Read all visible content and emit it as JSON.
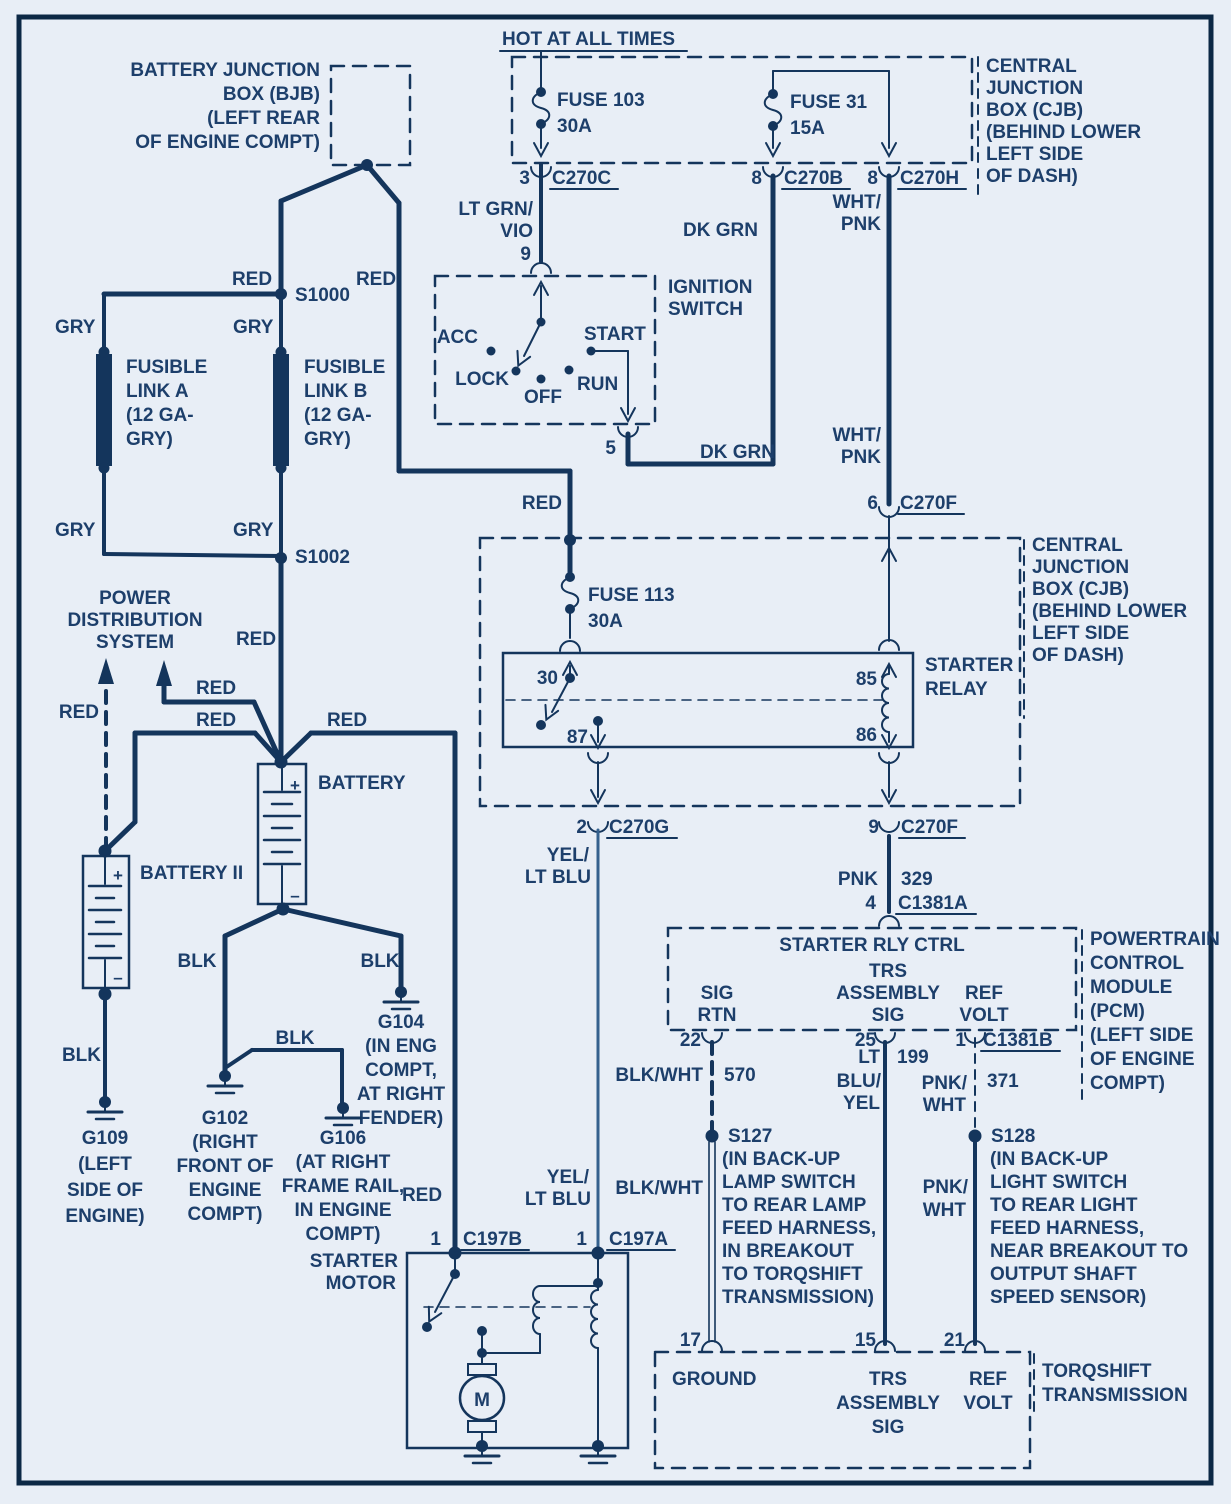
{
  "colors": {
    "background": "#e8eef6",
    "line": "#14355c",
    "text": "#1d3f6b",
    "wire_light": "#35618e"
  },
  "header": {
    "hot_at_all_times": "HOT AT ALL TIMES"
  },
  "bjb": {
    "label": [
      "BATTERY JUNCTION",
      "BOX (BJB)",
      "(LEFT REAR",
      "OF ENGINE COMPT)"
    ]
  },
  "cjb_top": {
    "label": [
      "CENTRAL",
      "JUNCTION",
      "BOX (CJB)",
      "(BEHIND LOWER",
      "LEFT SIDE",
      "OF DASH)"
    ],
    "fuse103": {
      "name": "FUSE 103",
      "rating": "30A"
    },
    "fuse31": {
      "name": "FUSE 31",
      "rating": "15A"
    }
  },
  "cjb_mid": {
    "label": [
      "CENTRAL",
      "JUNCTION",
      "BOX (CJB)",
      "(BEHIND LOWER",
      "LEFT SIDE",
      "OF DASH)"
    ],
    "fuse113": {
      "name": "FUSE 113",
      "rating": "30A"
    },
    "relay": {
      "label": [
        "STARTER",
        "RELAY"
      ],
      "pin30": "30",
      "pin85": "85",
      "pin86": "86",
      "pin87": "87"
    }
  },
  "ignition": {
    "label": [
      "IGNITION",
      "SWITCH"
    ],
    "acc": "ACC",
    "lock": "LOCK",
    "off": "OFF",
    "run": "RUN",
    "start": "START",
    "pin9": "9",
    "pin5": "5"
  },
  "pcm": {
    "label": [
      "POWERTRAIN",
      "CONTROL",
      "MODULE",
      "(PCM)",
      "(LEFT SIDE",
      "OF ENGINE",
      "COMPT)"
    ],
    "starter_rly_ctrl": "STARTER RLY CTRL",
    "sig_rtn": [
      "SIG",
      "RTN"
    ],
    "trs_assembly": [
      "TRS",
      "ASSEMBLY",
      "SIG"
    ],
    "ref_volt": [
      "REF",
      "VOLT"
    ],
    "pin22": "22",
    "pin25": "25",
    "pin1": "1"
  },
  "transmission": {
    "label": [
      "TORQSHIFT",
      "TRANSMISSION"
    ],
    "ground": "GROUND",
    "trs_assembly": [
      "TRS",
      "ASSEMBLY",
      "SIG"
    ],
    "ref_volt": [
      "REF",
      "VOLT"
    ],
    "pin17": "17",
    "pin15": "15",
    "pin21": "21"
  },
  "starter_motor": {
    "label": [
      "STARTER",
      "MOTOR"
    ],
    "motor": "M"
  },
  "power_distribution": {
    "label": [
      "POWER",
      "DISTRIBUTION",
      "SYSTEM"
    ]
  },
  "batteries": {
    "battery": "BATTERY",
    "battery2": "BATTERY II",
    "plus": "+",
    "minus": "–"
  },
  "fusible_links": {
    "a": [
      "FUSIBLE",
      "LINK A",
      "(12 GA-",
      "GRY)"
    ],
    "b": [
      "FUSIBLE",
      "LINK B",
      "(12 GA-",
      "GRY)"
    ]
  },
  "splices": {
    "s1000": "S1000",
    "s1002": "S1002",
    "s127": {
      "name": "S127",
      "note": [
        "(IN BACK-UP",
        "LAMP SWITCH",
        "TO REAR LAMP",
        "FEED HARNESS,",
        "IN BREAKOUT",
        "TO TORQSHIFT",
        "TRANSMISSION)"
      ]
    },
    "s128": {
      "name": "S128",
      "note": [
        "(IN BACK-UP",
        "LIGHT SWITCH",
        "TO REAR LIGHT",
        "FEED HARNESS,",
        "NEAR BREAKOUT TO",
        "OUTPUT SHAFT",
        "SPEED SENSOR)"
      ]
    }
  },
  "grounds": {
    "g109": [
      "G109",
      "(LEFT",
      "SIDE OF",
      "ENGINE)"
    ],
    "g102": [
      "G102",
      "(RIGHT",
      "FRONT OF",
      "ENGINE",
      "COMPT)"
    ],
    "g106": [
      "G106",
      "(AT RIGHT",
      "FRAME RAIL,",
      "IN ENGINE",
      "COMPT)"
    ],
    "g104": [
      "G104",
      "(IN ENG",
      "COMPT,",
      "AT RIGHT",
      "FENDER)"
    ]
  },
  "connectors": {
    "c270c": {
      "pin": "3",
      "name": "C270C"
    },
    "c270b": {
      "pin": "8",
      "name": "C270B"
    },
    "c270h": {
      "pin": "8",
      "name": "C270H"
    },
    "c270f_6": {
      "pin": "6",
      "name": "C270F"
    },
    "c270g": {
      "pin": "2",
      "name": "C270G"
    },
    "c270f_9": {
      "pin": "9",
      "name": "C270F"
    },
    "c1381a": {
      "pin": "4",
      "name": "C1381A"
    },
    "c1381b": {
      "pin": "1",
      "name": "C1381B"
    },
    "c197b": {
      "pin": "1",
      "name": "C197B"
    },
    "c197a": {
      "pin": "1",
      "name": "C197A"
    }
  },
  "wire_labels": {
    "red": "RED",
    "gry": "GRY",
    "blk": "BLK",
    "dk_grn": "DK GRN",
    "pnk": "PNK",
    "blk_wht": "BLK/WHT",
    "lt_grn_vio": [
      "LT GRN/",
      "VIO"
    ],
    "wht_pnk": [
      "WHT/",
      "PNK"
    ],
    "yel_lt_blu": [
      "YEL/",
      "LT BLU"
    ],
    "lt_blu_yel": [
      "LT",
      "BLU/",
      "YEL"
    ],
    "pnk_wht": [
      "PNK/",
      "WHT"
    ]
  },
  "circuit_numbers": {
    "c570": "570",
    "c199": "199",
    "c371": "371",
    "c329": "329"
  }
}
